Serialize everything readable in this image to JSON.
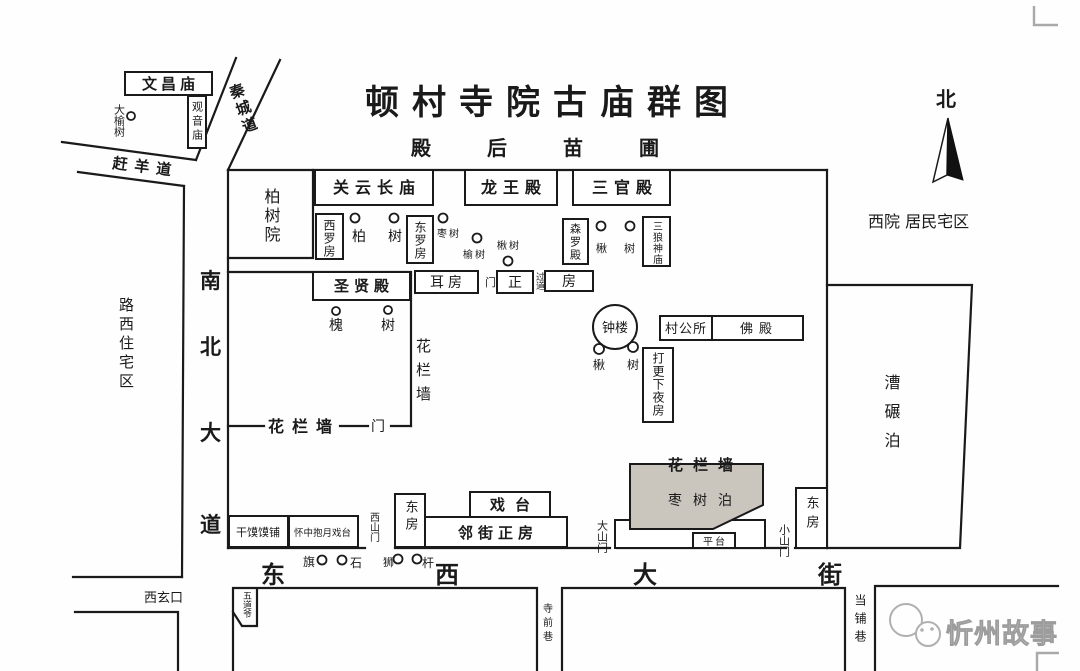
{
  "map": {
    "title": "顿村寺院古庙群图",
    "rear_garden": "殿后苗圃",
    "north_label": "北",
    "watermark": "忻州故事"
  },
  "roads": {
    "qincheng": "秦城道",
    "ganyang": "赶羊道",
    "nanbei_dadao": [
      "南",
      "北",
      "大",
      "道"
    ],
    "dongxi_dajie": [
      "东",
      "西",
      "大",
      "街"
    ],
    "xixuankou": "西玄口",
    "siqian_lane": "寺前巷",
    "dangpu_lane": "当铺巷"
  },
  "districts": {
    "luxi_residential": "路西住宅区",
    "west_yard_residential": "西院 居民宅区",
    "caonian_po": "漕碾泊",
    "wudaoye": "五道爷"
  },
  "northwest": {
    "wenchang_temple": "文昌庙",
    "guanyin_temple": "观音庙",
    "big_elm": "大榆树"
  },
  "temple": {
    "baishu_yard": "柏树院",
    "guanyunchang_temple": "关云长庙",
    "longwang_hall": "龙王殿",
    "sanguan_hall": "三官殿",
    "xiluo_room": "西罗房",
    "dongluo_room": "东罗房",
    "senluo_hall": "森罗殿",
    "sanlang_temple": "三狼神庙",
    "shengxian_hall": "圣贤殿",
    "er_room": "耳房",
    "gate_small": "门",
    "zheng_room_left": "正",
    "passage": "过道",
    "zheng_room_right": "房",
    "bell_tower": "钟楼",
    "village_office": "村公所",
    "buddha_hall": "佛殿",
    "night_watch_room": "打更下夜房",
    "flower_wall_east": "花栏墙",
    "flower_wall_south": "花栏墙",
    "flower_wall_gate": "门",
    "flower_wall_zao": "花栏墙",
    "zaoshu_po": "枣树泊",
    "platform": "平台",
    "great_gate": "大山门",
    "small_gate": "小山门",
    "west_gate": "西山门",
    "east_room_west": "东房",
    "east_room_east": "东房",
    "ganmomo_shop": "干馍馍铺",
    "huaizhong_stage": "怀中抱月戏台",
    "stage": "戏台",
    "street_front_house": "邻街正房"
  },
  "trees": {
    "bai": "柏",
    "shu_a": "树",
    "zaoshu": "枣树",
    "yushu": "榆树",
    "qiushu": "楸树",
    "qiu_a": "楸",
    "shu_b": "树",
    "huai": "槐",
    "shu_c": "树",
    "qiu_b": "楸",
    "shu_d": "树"
  },
  "street_items": {
    "flag": "旗",
    "stone": "石",
    "lion": "狮",
    "pole": "杆"
  }
}
